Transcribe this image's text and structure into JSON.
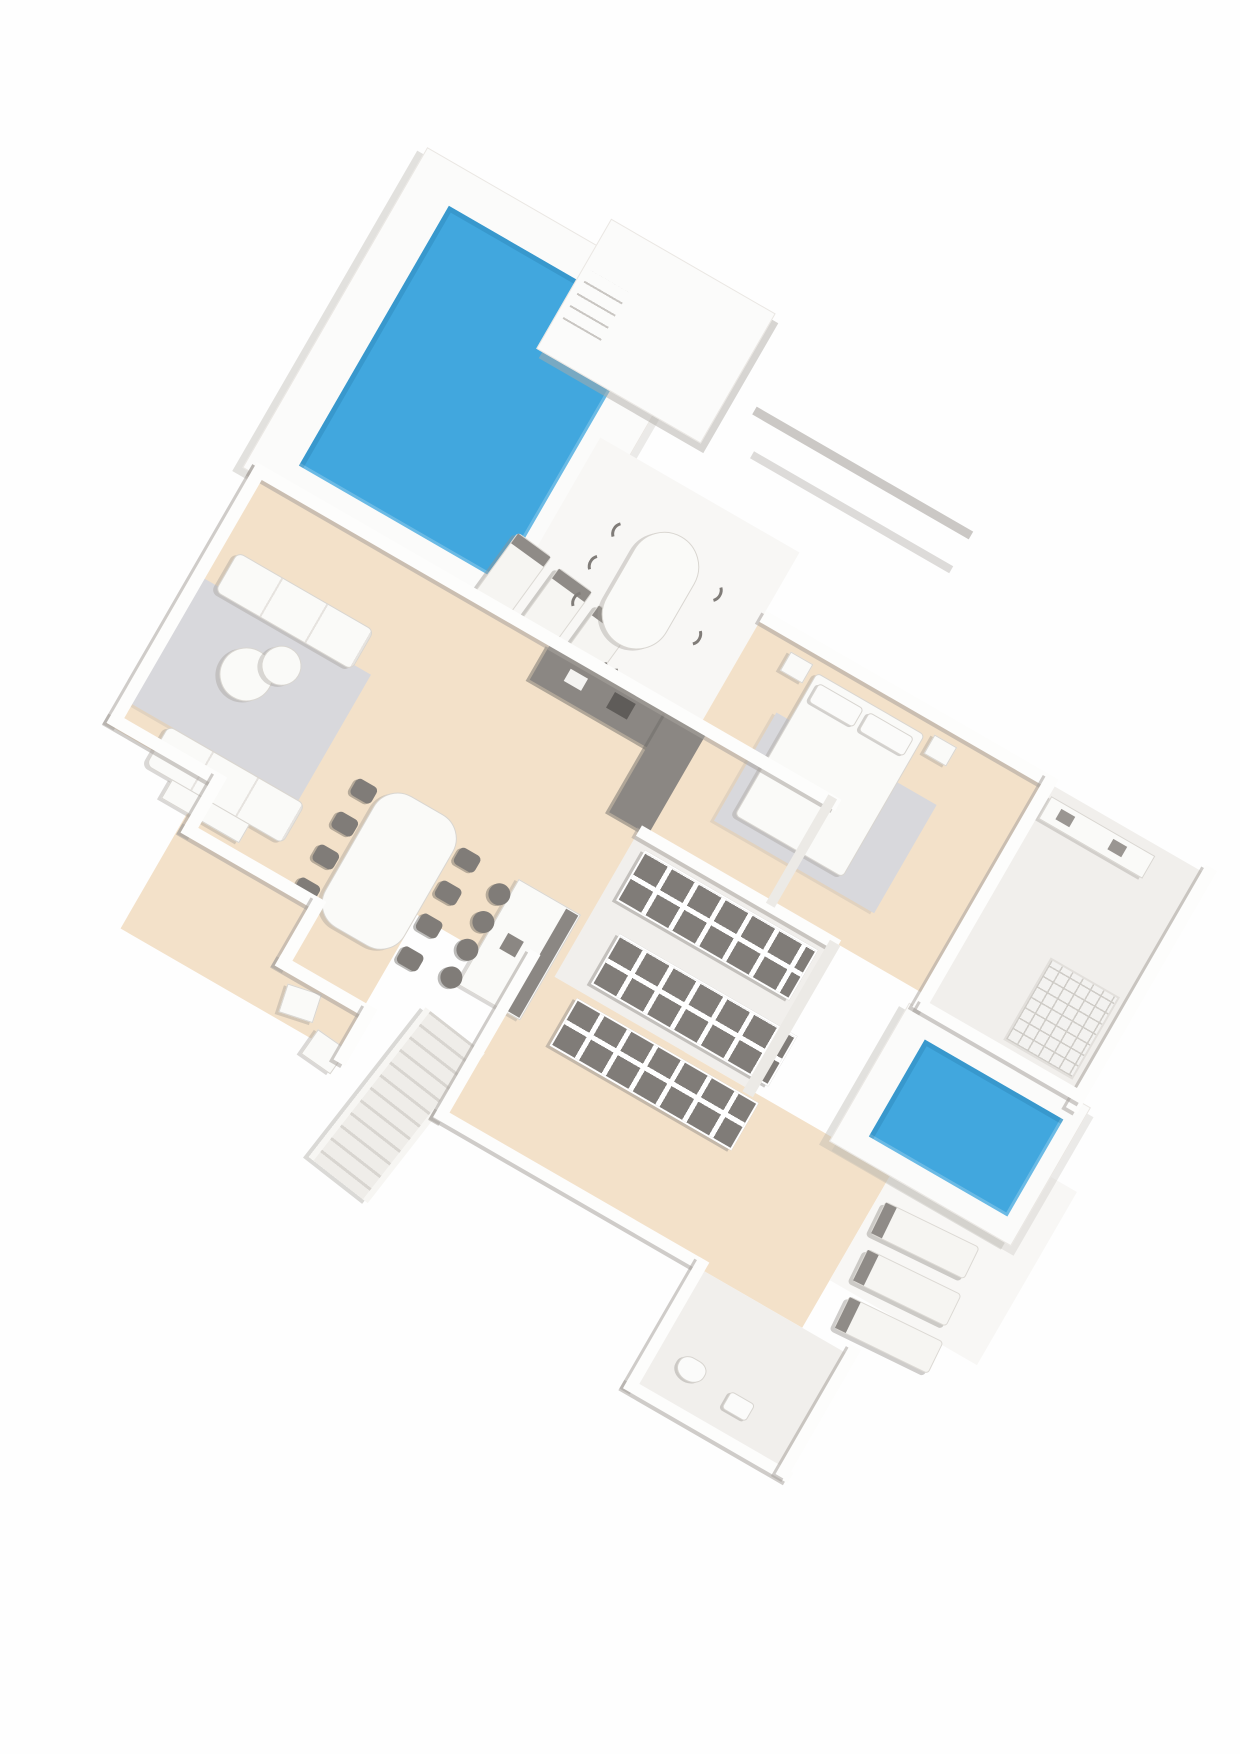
{
  "document": {
    "kind": "scanned 3D floor plan of a villa",
    "paper_color": "#ffffff",
    "plan_rotation_deg": 30,
    "visible_text": []
  },
  "palette": {
    "pool_water": "#41a7de",
    "pool_water_edge": "#2b86b8",
    "floor_beige": "#f3e1c9",
    "floor_light": "#f1efec",
    "terrace_white": "#f8f7f5",
    "rug_gray": "#d8d8dc",
    "wall_face": "#fdfdfc",
    "wall_shadow": "#aaa59f",
    "furniture_white": "#fafaf8",
    "furniture_outline": "#d9d6d1",
    "furniture_dark": "#807c78",
    "appliance_dark": "#5f5c59"
  },
  "features": {
    "pools": [
      {
        "name": "main pool",
        "area": "upper pool terrace",
        "color_key": "pool_water"
      },
      {
        "name": "plunge pool",
        "area": "lower-right terrace",
        "color_key": "pool_water"
      }
    ],
    "rooms": [
      {
        "name": "pool terrace",
        "furniture": [
          "sun lounger",
          "sun lounger",
          "sun lounger",
          "oval outdoor dining table",
          "outdoor chairs (6)"
        ]
      },
      {
        "name": "pool house",
        "furniture": [
          "entry steps"
        ]
      },
      {
        "name": "living room",
        "furniture": [
          "sofa",
          "sofa",
          "round coffee table set",
          "area rug",
          "sideboard",
          "armchair",
          "armchair"
        ]
      },
      {
        "name": "dining area",
        "furniture": [
          "dining table",
          "dining chairs (8)"
        ]
      },
      {
        "name": "kitchen",
        "furniture": [
          "L-shaped counter with sink and hob",
          "island breakfast bar",
          "bar stools (4)"
        ]
      },
      {
        "name": "bedroom",
        "furniture": [
          "double bed",
          "pillows (2)",
          "area rug",
          "nightstand",
          "nightstand"
        ]
      },
      {
        "name": "walk-in closet",
        "furniture": [
          "wardrobe unit",
          "wardrobe unit",
          "wardrobe unit"
        ]
      },
      {
        "name": "en-suite bathroom",
        "furniture": [
          "walk-in shower",
          "vanity"
        ]
      },
      {
        "name": "hallway",
        "furniture": []
      },
      {
        "name": "guest bathroom",
        "furniture": [
          "toilet",
          "washbasin"
        ]
      },
      {
        "name": "garden stairs",
        "furniture": [
          "staircase ramp"
        ]
      },
      {
        "name": "plunge pool terrace",
        "furniture": [
          "sun lounger",
          "sun lounger",
          "sun lounger"
        ]
      }
    ]
  }
}
